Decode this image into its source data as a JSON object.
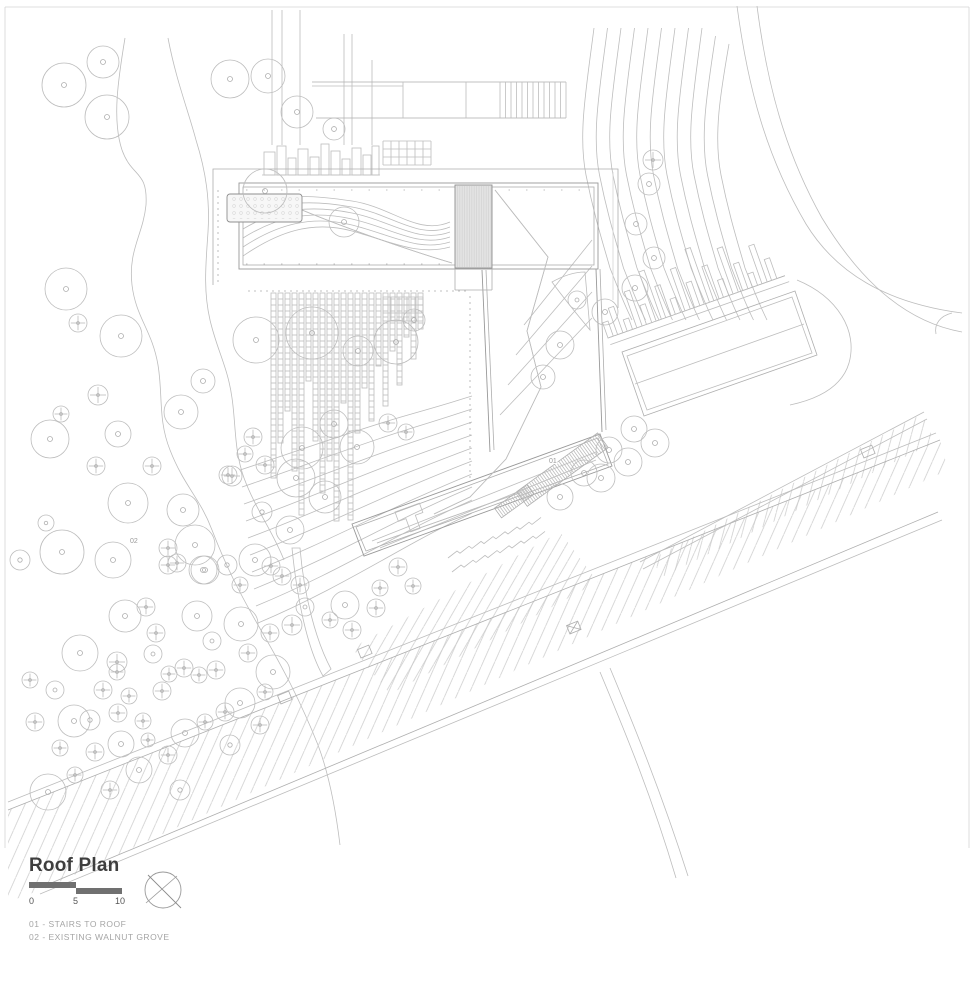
{
  "title_block": {
    "title": "Roof Plan",
    "scale_bar": {
      "labels": [
        "0",
        "5",
        "10"
      ]
    },
    "legend": [
      "01 - STAIRS TO ROOF",
      "02 - EXISTING WALNUT GROVE"
    ],
    "compass": "north-arrow"
  },
  "colors": {
    "line": "#bdbdbd",
    "line_dark": "#999999",
    "line_light": "#d4d4d4",
    "hatch": "#c9c9c9",
    "stair_fill": "#e3e3e3",
    "paper": "#ffffff",
    "title_text": "#3e3e3e",
    "scale_bar": "#707070",
    "legend_text": "#a5a5a5",
    "plan_label": "#9a9a9a"
  },
  "plan": {
    "labels": [
      {
        "text": "01",
        "x": 549,
        "y": 463
      },
      {
        "text": "02",
        "x": 130,
        "y": 543
      }
    ],
    "strips": [
      [
        271,
        185
      ],
      [
        278,
        150
      ],
      [
        285,
        118
      ],
      [
        292,
        178
      ],
      [
        299,
        222
      ],
      [
        306,
        88
      ],
      [
        313,
        148
      ],
      [
        320,
        200
      ],
      [
        327,
        168
      ],
      [
        334,
        228
      ],
      [
        341,
        110
      ],
      [
        348,
        227
      ],
      [
        355,
        140
      ],
      [
        362,
        95
      ],
      [
        369,
        128
      ],
      [
        376,
        73
      ],
      [
        383,
        113
      ],
      [
        390,
        58
      ],
      [
        397,
        92
      ],
      [
        404,
        44
      ],
      [
        411,
        66
      ],
      [
        418,
        36
      ]
    ],
    "blocks": [
      [
        264,
        152,
        11,
        23
      ],
      [
        277,
        146,
        9,
        29
      ],
      [
        288,
        158,
        8,
        17
      ],
      [
        298,
        149,
        10,
        26
      ],
      [
        310,
        157,
        9,
        18
      ],
      [
        321,
        144,
        8,
        31
      ],
      [
        331,
        151,
        9,
        24
      ],
      [
        342,
        159,
        8,
        16
      ],
      [
        352,
        148,
        9,
        27
      ],
      [
        363,
        155,
        8,
        20
      ],
      [
        372,
        146,
        7,
        29
      ]
    ],
    "grids": [
      {
        "x": 383,
        "y": 141,
        "cols": 6,
        "rows": 3,
        "cell": 8
      },
      {
        "x": 383,
        "y": 297,
        "cols": 5,
        "rows": 3,
        "cell": 8
      }
    ],
    "piers": {
      "x1": 608,
      "y1": 338,
      "angle": -19.4,
      "spacing": 10.2,
      "width": 5.6,
      "heights": [
        16,
        28,
        12,
        38,
        20,
        52,
        33,
        16,
        44,
        26,
        58,
        36,
        18,
        48,
        28,
        14,
        40,
        22
      ]
    },
    "trees": [
      [
        64,
        85,
        22,
        "d"
      ],
      [
        103,
        62,
        16,
        "d"
      ],
      [
        107,
        117,
        22,
        "d"
      ],
      [
        230,
        79,
        19,
        "d"
      ],
      [
        268,
        76,
        17,
        "d"
      ],
      [
        297,
        112,
        16,
        "d"
      ],
      [
        334,
        129,
        11,
        "d"
      ],
      [
        265,
        191,
        22,
        "d"
      ],
      [
        344,
        222,
        15,
        "d"
      ],
      [
        66,
        289,
        21,
        "d"
      ],
      [
        78,
        323,
        9,
        "c"
      ],
      [
        121,
        336,
        21,
        "d"
      ],
      [
        98,
        395,
        10,
        "c"
      ],
      [
        61,
        414,
        8,
        "c"
      ],
      [
        50,
        439,
        19,
        "d"
      ],
      [
        118,
        434,
        13,
        "d"
      ],
      [
        181,
        412,
        17,
        "d"
      ],
      [
        203,
        381,
        12,
        "d"
      ],
      [
        96,
        466,
        9,
        "c"
      ],
      [
        152,
        466,
        9,
        "c"
      ],
      [
        232,
        476,
        10,
        "c"
      ],
      [
        253,
        437,
        9,
        "c"
      ],
      [
        245,
        454,
        8,
        "c"
      ],
      [
        228,
        475,
        9,
        "c"
      ],
      [
        265,
        465,
        9,
        "c"
      ],
      [
        128,
        503,
        20,
        "d"
      ],
      [
        183,
        510,
        16,
        "d"
      ],
      [
        62,
        552,
        22,
        "d"
      ],
      [
        113,
        560,
        18,
        "d"
      ],
      [
        20,
        560,
        10,
        "d"
      ],
      [
        168,
        548,
        9,
        "c"
      ],
      [
        177,
        563,
        9,
        "c"
      ],
      [
        195,
        545,
        20,
        "d"
      ],
      [
        205,
        570,
        14,
        "d"
      ],
      [
        46,
        523,
        8,
        "d"
      ],
      [
        256,
        340,
        23,
        "d"
      ],
      [
        312,
        333,
        26,
        "d"
      ],
      [
        358,
        351,
        15,
        "d"
      ],
      [
        396,
        342,
        22,
        "d"
      ],
      [
        414,
        320,
        11,
        "d"
      ],
      [
        334,
        424,
        14,
        "d"
      ],
      [
        302,
        448,
        21,
        "d"
      ],
      [
        357,
        447,
        17,
        "d"
      ],
      [
        296,
        478,
        19,
        "d"
      ],
      [
        325,
        497,
        16,
        "d"
      ],
      [
        290,
        530,
        14,
        "d"
      ],
      [
        262,
        512,
        10,
        "d"
      ],
      [
        388,
        423,
        9,
        "c"
      ],
      [
        406,
        432,
        8,
        "c"
      ],
      [
        653,
        160,
        10,
        "c"
      ],
      [
        649,
        184,
        11,
        "d"
      ],
      [
        636,
        224,
        11,
        "d"
      ],
      [
        654,
        258,
        11,
        "d"
      ],
      [
        635,
        288,
        13,
        "d"
      ],
      [
        605,
        312,
        13,
        "d"
      ],
      [
        560,
        345,
        14,
        "d"
      ],
      [
        543,
        377,
        12,
        "d"
      ],
      [
        577,
        300,
        9,
        "d"
      ],
      [
        560,
        497,
        13,
        "d"
      ],
      [
        584,
        473,
        13,
        "d"
      ],
      [
        609,
        450,
        13,
        "d"
      ],
      [
        634,
        429,
        13,
        "d"
      ],
      [
        655,
        443,
        14,
        "d"
      ],
      [
        628,
        462,
        14,
        "d"
      ],
      [
        601,
        478,
        14,
        "d"
      ],
      [
        255,
        560,
        16,
        "d"
      ],
      [
        203,
        570,
        14,
        "d"
      ],
      [
        227,
        565,
        10,
        "d"
      ],
      [
        168,
        565,
        9,
        "c"
      ],
      [
        271,
        566,
        9,
        "c"
      ],
      [
        282,
        576,
        9,
        "c"
      ],
      [
        240,
        585,
        8,
        "c"
      ],
      [
        300,
        585,
        9,
        "c"
      ],
      [
        305,
        607,
        9,
        "d"
      ],
      [
        345,
        605,
        14,
        "d"
      ],
      [
        376,
        608,
        9,
        "c"
      ],
      [
        380,
        588,
        8,
        "c"
      ],
      [
        352,
        630,
        9,
        "c"
      ],
      [
        330,
        620,
        8,
        "c"
      ],
      [
        398,
        567,
        9,
        "c"
      ],
      [
        413,
        586,
        8,
        "c"
      ],
      [
        125,
        616,
        16,
        "d"
      ],
      [
        197,
        616,
        15,
        "d"
      ],
      [
        241,
        624,
        17,
        "d"
      ],
      [
        80,
        653,
        18,
        "d"
      ],
      [
        153,
        654,
        9,
        "d"
      ],
      [
        212,
        641,
        9,
        "d"
      ],
      [
        146,
        607,
        9,
        "c"
      ],
      [
        156,
        633,
        9,
        "c"
      ],
      [
        117,
        662,
        10,
        "c"
      ],
      [
        117,
        672,
        8,
        "c"
      ],
      [
        103,
        690,
        9,
        "c"
      ],
      [
        129,
        696,
        8,
        "c"
      ],
      [
        118,
        713,
        9,
        "c"
      ],
      [
        162,
        691,
        9,
        "c"
      ],
      [
        169,
        674,
        8,
        "c"
      ],
      [
        184,
        668,
        9,
        "c"
      ],
      [
        199,
        675,
        8,
        "c"
      ],
      [
        216,
        670,
        9,
        "c"
      ],
      [
        248,
        653,
        9,
        "c"
      ],
      [
        270,
        633,
        9,
        "c"
      ],
      [
        292,
        625,
        10,
        "c"
      ],
      [
        74,
        721,
        16,
        "d"
      ],
      [
        143,
        721,
        8,
        "c"
      ],
      [
        185,
        733,
        14,
        "d"
      ],
      [
        240,
        703,
        15,
        "d"
      ],
      [
        121,
        744,
        13,
        "d"
      ],
      [
        148,
        740,
        7,
        "c"
      ],
      [
        139,
        770,
        13,
        "d"
      ],
      [
        48,
        792,
        18,
        "d"
      ],
      [
        273,
        672,
        17,
        "d"
      ],
      [
        265,
        692,
        8,
        "c"
      ],
      [
        225,
        712,
        9,
        "c"
      ],
      [
        205,
        722,
        8,
        "c"
      ],
      [
        168,
        755,
        9,
        "c"
      ],
      [
        95,
        752,
        9,
        "c"
      ],
      [
        60,
        748,
        8,
        "c"
      ],
      [
        35,
        722,
        9,
        "c"
      ],
      [
        30,
        680,
        8,
        "c"
      ],
      [
        55,
        690,
        9,
        "d"
      ],
      [
        90,
        720,
        10,
        "d"
      ],
      [
        110,
        790,
        9,
        "c"
      ],
      [
        75,
        775,
        8,
        "c"
      ],
      [
        230,
        745,
        10,
        "d"
      ],
      [
        260,
        725,
        9,
        "c"
      ],
      [
        180,
        790,
        10,
        "d"
      ]
    ]
  }
}
